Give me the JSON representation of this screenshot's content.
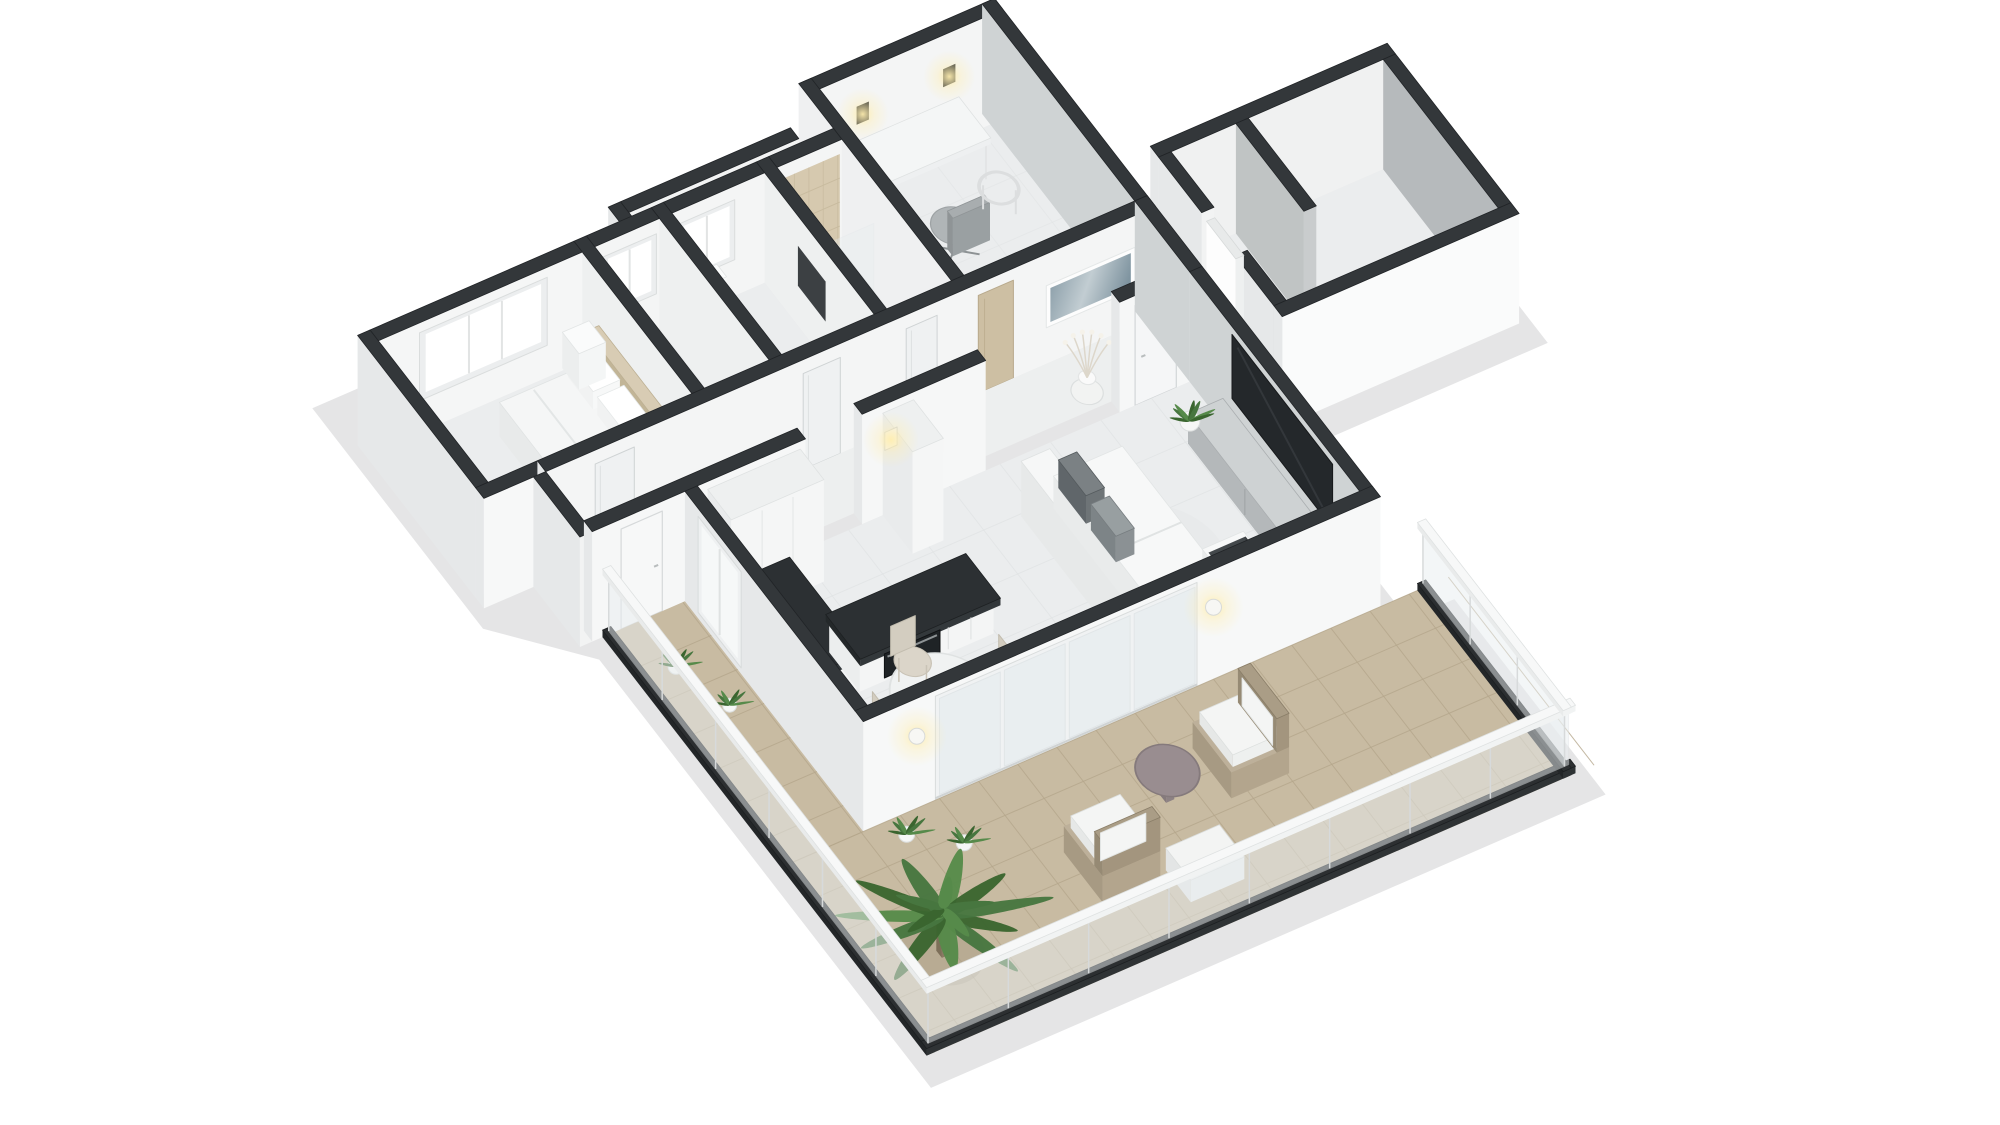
{
  "view": {
    "type": "3d-floorplan-render",
    "style": "isometric-dollhouse",
    "background": "#ffffff"
  },
  "palette": {
    "wallTop": "#33373a",
    "wallEdge": "#212427",
    "extWall": "#e6e8e9",
    "extWallBright": "#f7f8f8",
    "innerWallLight": "#f5f6f6",
    "innerWallGray": "#cfd3d4",
    "innerWallDark": "#b6babc",
    "wallCap": "#c9cccd",
    "floor": "#ebedee",
    "floorLine": "#e0e3e4",
    "terraceFloor": "#c8bba2",
    "terraceLine": "#b5a78c",
    "glass": "#e9eef0",
    "frame": "#f0f2f3",
    "doorWood": "#cdbfa3",
    "showerTile": "#d6c9af",
    "counterDark": "#2c3033",
    "applianceDark": "#1f2326",
    "tv": "#24282b",
    "sideboard": "#b4b8ba",
    "sofa": "#f2f3f3",
    "cushionDark": "#6e7477",
    "cushionMid": "#8b9194",
    "throwDark": "#43484b",
    "headboard": "#cfc2a8",
    "fixtureWhite": "#fbfcfc",
    "plantDark": "#3a652f",
    "plantMid": "#47763f",
    "plantLight": "#568a4a",
    "wicker": "#b3a58d",
    "wickerDark": "#a3957e",
    "tableMauve": "#998d90",
    "balustradeBase": "#2c2f31",
    "shadow": "#2a2d2f",
    "glow": "#ffeeb0",
    "artA": "#7f94a0",
    "artB": "#c2cdd2"
  },
  "scene": {
    "rooms": [
      {
        "name": "bedroom"
      },
      {
        "name": "closet-room"
      },
      {
        "name": "bathroom"
      },
      {
        "name": "shower-room"
      },
      {
        "name": "office"
      },
      {
        "name": "hallway"
      },
      {
        "name": "kitchen"
      },
      {
        "name": "dining-area"
      },
      {
        "name": "living-room"
      },
      {
        "name": "patio-lightwell"
      },
      {
        "name": "annex-storage-room"
      },
      {
        "name": "terrace"
      }
    ],
    "furniture": [
      "double-bed",
      "nightstand",
      "toilet",
      "shower-tray",
      "desk",
      "office-chair",
      "visitor-chair",
      "wall-sconce",
      "hall-artwork",
      "branch-vase",
      "snake-plant",
      "tall-cabinets",
      "fridge-column",
      "kitchen-counter",
      "oven",
      "dining-table",
      "dining-chair",
      "sofa",
      "tv",
      "tv-sideboard",
      "potted-plant",
      "side-stool",
      "wicker-armchair",
      "outdoor-side-table",
      "outdoor-ottoman",
      "palm-plant",
      "glass-balustrade",
      "sliding-glass-door",
      "exterior-lamp"
    ]
  }
}
